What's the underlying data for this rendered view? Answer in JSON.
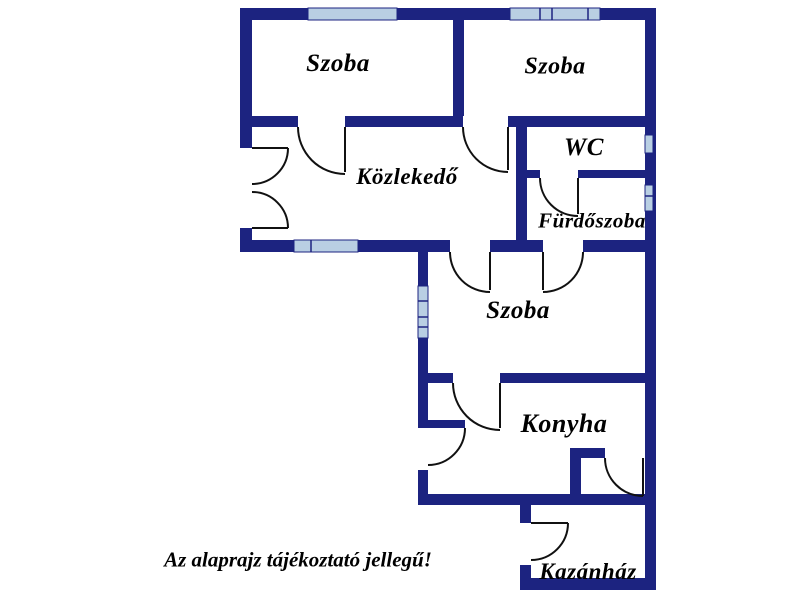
{
  "colors": {
    "background": "#ffffff",
    "wall": "#1c2380",
    "window": "#b9cfe3",
    "door": "#111111",
    "text": "#000000"
  },
  "rooms": {
    "szoba_top_left": "Szoba",
    "szoba_top_right": "Szoba",
    "wc": "WC",
    "kozlekedo": "Közlekedő",
    "furdoszoba": "Fürdőszoba",
    "szoba_middle": "Szoba",
    "konyha": "Konyha",
    "kazanhaz": "Kazánház"
  },
  "disclaimer": "Az alaprajz tájékoztató jellegű!",
  "legend": {
    "wall_meaning": "wall",
    "window_meaning": "window",
    "arc_meaning": "door-swing"
  }
}
